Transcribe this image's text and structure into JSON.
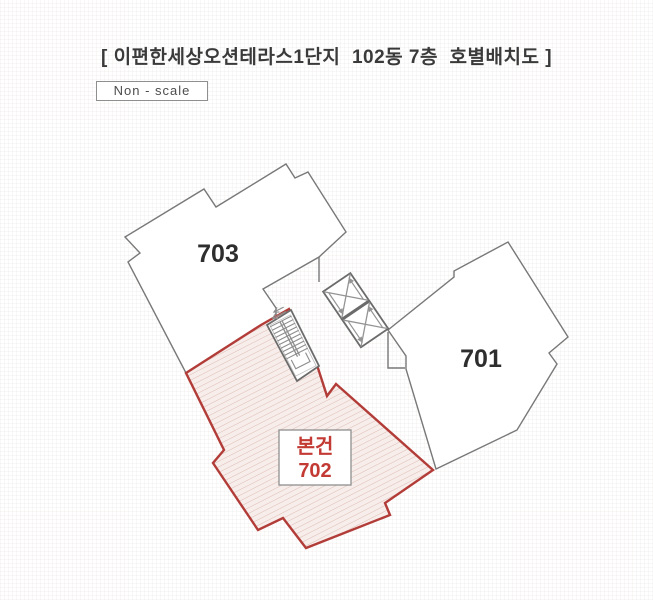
{
  "header": {
    "title": "[ 이편한세상오션테라스1단지  102동 7층  호별배치도 ]",
    "scale_note": "Non - scale"
  },
  "floorplan": {
    "unit_703_label": "703",
    "unit_701_label": "701",
    "subject_unit": {
      "tag": "본건",
      "number": "702"
    },
    "core": {
      "stair": "stairs",
      "elevators": "2 elevators"
    },
    "colors": {
      "subject_outline": "#b23c38",
      "subject_fill": "#f7edea",
      "subject_text": "#c23a33",
      "unit_outline": "#787878",
      "core_outline": "#6b6b6b"
    }
  }
}
